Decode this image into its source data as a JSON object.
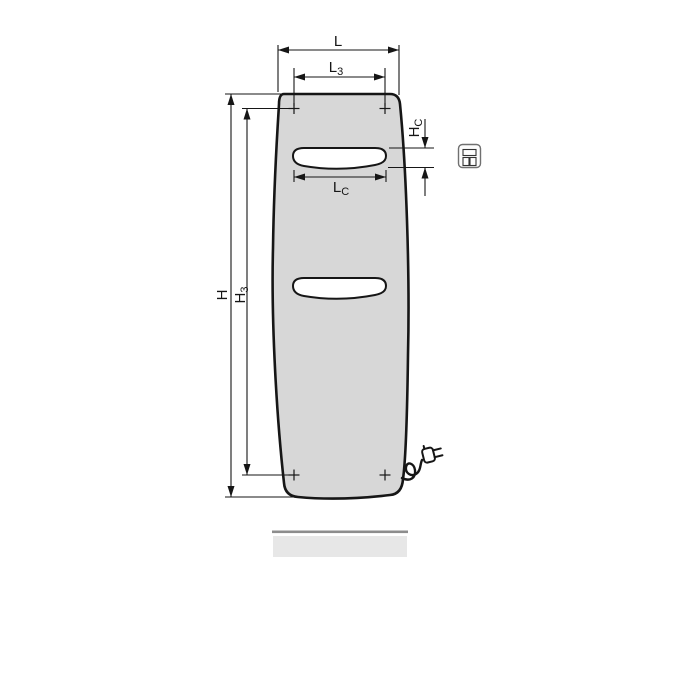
{
  "diagram": {
    "type": "technical-dimension-drawing",
    "subject": "vertical panel radiator, front view, with towel cut-outs, mounting points, electric plug and floor line",
    "dims": {
      "total_width": {
        "base": "L",
        "sub": ""
      },
      "mount_width": {
        "base": "L",
        "sub": "3"
      },
      "total_height": {
        "base": "H",
        "sub": ""
      },
      "mount_height": {
        "base": "H",
        "sub": "3"
      },
      "cutout_height": {
        "base": "H",
        "sub": "C"
      },
      "cutout_width": {
        "base": "L",
        "sub": "C"
      }
    },
    "icon": {
      "name": "radiator-variant-icon"
    },
    "colors": {
      "background": "#ffffff",
      "panel-fill": "#d7d7d7",
      "panel-outline": "#161616",
      "cutout-fill": "#ffffff",
      "dimension-line": "#161616",
      "floor-bar-fill": "#e7e7e7",
      "floor-bar-edge": "#8d8d8d",
      "icon-border": "#707070",
      "icon-detail": "#333333"
    }
  }
}
